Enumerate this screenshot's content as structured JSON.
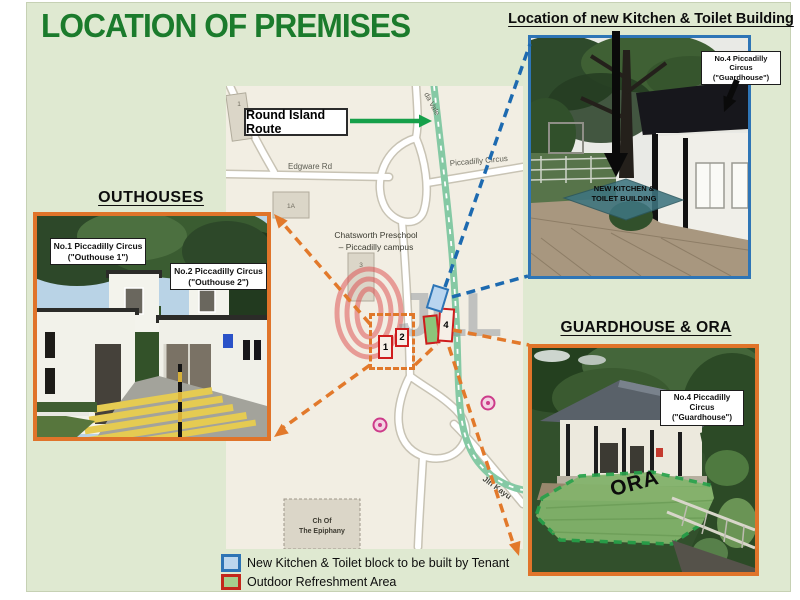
{
  "slide": {
    "title": "LOCATION OF PREMISES"
  },
  "insets": {
    "kitchen": {
      "heading": "Location of new Kitchen & Toilet Building",
      "label_line1": "No.4 Piccadilly Circus",
      "label_line2": "(\"Guardhouse\")",
      "area_line1": "NEW KITCHEN &",
      "area_line2": "TOILET BUILDING"
    },
    "outhouses": {
      "heading": "OUTHOUSES",
      "label1_line1": "No.1 Piccadilly Circus",
      "label1_line2": "(\"Outhouse 1\")",
      "label2_line1": "No.2 Piccadilly Circus",
      "label2_line2": "(\"Outhouse 2\")"
    },
    "guardhouse": {
      "heading": "GUARDHOUSE & ORA",
      "label_line1": "No.4 Piccadilly Circus",
      "label_line2": "(\"Guardhouse\")",
      "ora_label": "ORA"
    }
  },
  "map": {
    "route_label": "Round Island Route",
    "roads": {
      "edgware": "Edgware Rd",
      "piccadilly": "Piccadilly Circus",
      "da_vale": "da Vale",
      "jln_kayu": "Jln Kayu"
    },
    "places": {
      "preschool_line1": "Chatsworth Preschool",
      "preschool_line2": "– Piccadilly campus",
      "church_line1": "Ch Of",
      "church_line2": "The Epiphany",
      "building_1": "1",
      "building_1a": "1A",
      "building_3": "3"
    },
    "markers": {
      "m1": "1",
      "m2": "2",
      "m4": "4"
    },
    "watermark": "JLL"
  },
  "legend": {
    "items": [
      {
        "label": "New Kitchen & Toilet block to be built by Tenant",
        "fill": "#bdd7ee",
        "border": "#2e74b5"
      },
      {
        "label": "Outdoor Refreshment Area",
        "fill": "#a5cf8d",
        "border": "#c3271b"
      }
    ]
  },
  "colors": {
    "slide_bg": "#dfe9d1",
    "title_green": "#1b7b2c",
    "orange_connector": "#e2792b",
    "blue_connector": "#1d6ab0",
    "route_green": "#16a04a",
    "ora_green": "#84b56d"
  }
}
